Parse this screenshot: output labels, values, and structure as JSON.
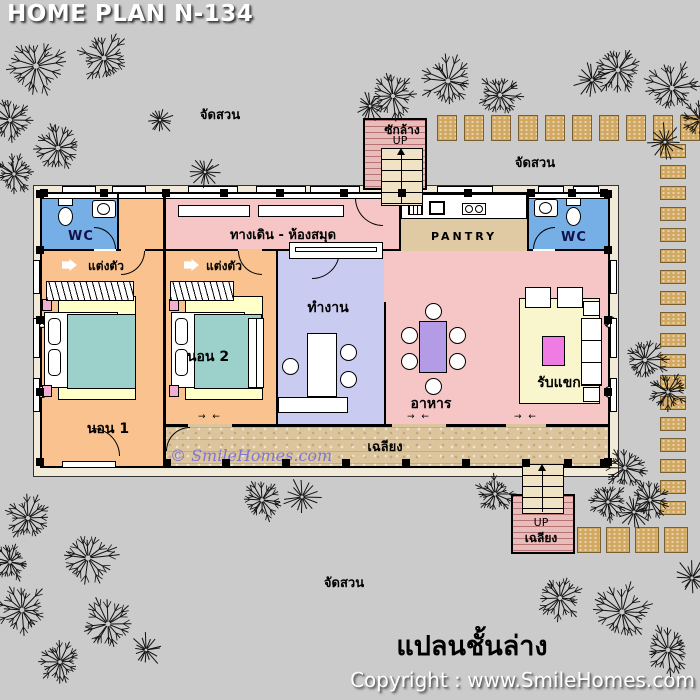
{
  "header": {
    "title": "HOME PLAN N-134"
  },
  "captions": {
    "floor_plan": "แปลนชั้นล่าง",
    "copyright": "Copyright : www.SmileHomes.com",
    "watermark": "© SmileHomes.com",
    "garden_label": "จัดสวน"
  },
  "rooms": {
    "hall_library": "ทางเดิน - ห้องสมุด",
    "pantry": "PANTRY",
    "wc": "WC",
    "dressing": "แต่งตัว",
    "bedroom1": "นอน 1",
    "bedroom2": "นอน 2",
    "office": "ทำงาน",
    "dining": "อาหาร",
    "living": "รับแขก",
    "porch": "เฉลียง",
    "laundry": "ซักล้าง",
    "up": "UP"
  },
  "symbols": {
    "door_swing": "→ ←"
  },
  "colors": {
    "bg": "#cbcbcb",
    "pink": "#f6c5c5",
    "orange": "#f9c28e",
    "lavender": "#cacbf0",
    "wcblue": "#76aee6",
    "porchtan": "#dcc49c",
    "pantrytan": "#dfcaa4",
    "stone": "#d2a963",
    "cream": "#f1ead9",
    "teal": "#9cd0ca",
    "rug": "#ffffc8",
    "livingrug": "#f9f6cd",
    "tablepurple": "#b49be5",
    "tablemagenta": "#ee7ce2",
    "laundry": "#e9bcbc",
    "stair": "#f0e2c4",
    "watermark": "#6b6be0"
  },
  "site": {
    "trees": [
      {
        "x": 36,
        "y": 66,
        "r": 34
      },
      {
        "x": 104,
        "y": 58,
        "r": 30
      },
      {
        "x": 10,
        "y": 120,
        "r": 26
      },
      {
        "x": 58,
        "y": 148,
        "r": 28
      },
      {
        "x": 14,
        "y": 174,
        "r": 22
      },
      {
        "x": 160,
        "y": 120,
        "r": 16
      },
      {
        "x": 205,
        "y": 172,
        "r": 17
      },
      {
        "x": 370,
        "y": 106,
        "r": 18
      },
      {
        "x": 393,
        "y": 96,
        "r": 26
      },
      {
        "x": 448,
        "y": 81,
        "r": 30
      },
      {
        "x": 500,
        "y": 95,
        "r": 26
      },
      {
        "x": 618,
        "y": 70,
        "r": 28
      },
      {
        "x": 672,
        "y": 88,
        "r": 30
      },
      {
        "x": 592,
        "y": 80,
        "r": 20
      },
      {
        "x": 700,
        "y": 120,
        "r": 22
      },
      {
        "x": 665,
        "y": 142,
        "r": 20
      },
      {
        "x": 645,
        "y": 360,
        "r": 26
      },
      {
        "x": 668,
        "y": 392,
        "r": 22
      },
      {
        "x": 625,
        "y": 468,
        "r": 24
      },
      {
        "x": 650,
        "y": 500,
        "r": 22
      },
      {
        "x": 495,
        "y": 494,
        "r": 22
      },
      {
        "x": 608,
        "y": 502,
        "r": 22
      },
      {
        "x": 634,
        "y": 512,
        "r": 20
      },
      {
        "x": 262,
        "y": 500,
        "r": 24
      },
      {
        "x": 302,
        "y": 497,
        "r": 20
      },
      {
        "x": 28,
        "y": 518,
        "r": 26
      },
      {
        "x": 88,
        "y": 558,
        "r": 32
      },
      {
        "x": 10,
        "y": 562,
        "r": 22
      },
      {
        "x": 22,
        "y": 610,
        "r": 30
      },
      {
        "x": 108,
        "y": 624,
        "r": 30
      },
      {
        "x": 60,
        "y": 662,
        "r": 24
      },
      {
        "x": 146,
        "y": 650,
        "r": 18
      },
      {
        "x": 560,
        "y": 598,
        "r": 26
      },
      {
        "x": 622,
        "y": 612,
        "r": 32
      },
      {
        "x": 668,
        "y": 650,
        "r": 28
      },
      {
        "x": 692,
        "y": 578,
        "r": 20
      }
    ],
    "stone_runs": [
      {
        "x": 437,
        "y": 115,
        "w": 20,
        "h": 26,
        "dx": 27,
        "dy": 0,
        "n": 10
      },
      {
        "x": 660,
        "y": 144,
        "w": 26,
        "h": 14,
        "dx": 0,
        "dy": 21,
        "n": 18
      },
      {
        "x": 577,
        "y": 527,
        "w": 24,
        "h": 26,
        "dx": 29,
        "dy": 0,
        "n": 4
      }
    ]
  },
  "structure": {
    "posts": {
      "top_xs": [
        40,
        100,
        162,
        220,
        276,
        340,
        398,
        464,
        527,
        568,
        600
      ],
      "bottom_xs": [
        163,
        222,
        282,
        342,
        402,
        462,
        522,
        564,
        600
      ],
      "left_ys": [
        190,
        246,
        316,
        388,
        458
      ],
      "right_ys": [
        190,
        246,
        316,
        388,
        458
      ]
    },
    "windows": [
      [
        62,
        186,
        34,
        7
      ],
      [
        112,
        186,
        34,
        7
      ],
      [
        188,
        186,
        50,
        7
      ],
      [
        256,
        186,
        50,
        7
      ],
      [
        310,
        186,
        50,
        7
      ],
      [
        437,
        186,
        56,
        7
      ],
      [
        538,
        186,
        26,
        7
      ],
      [
        573,
        186,
        26,
        7
      ],
      [
        33,
        260,
        7,
        34
      ],
      [
        33,
        318,
        7,
        40
      ],
      [
        33,
        378,
        7,
        34
      ],
      [
        610,
        260,
        7,
        34
      ],
      [
        610,
        318,
        7,
        40
      ],
      [
        610,
        378,
        7,
        34
      ],
      [
        62,
        461,
        54,
        7
      ]
    ]
  }
}
